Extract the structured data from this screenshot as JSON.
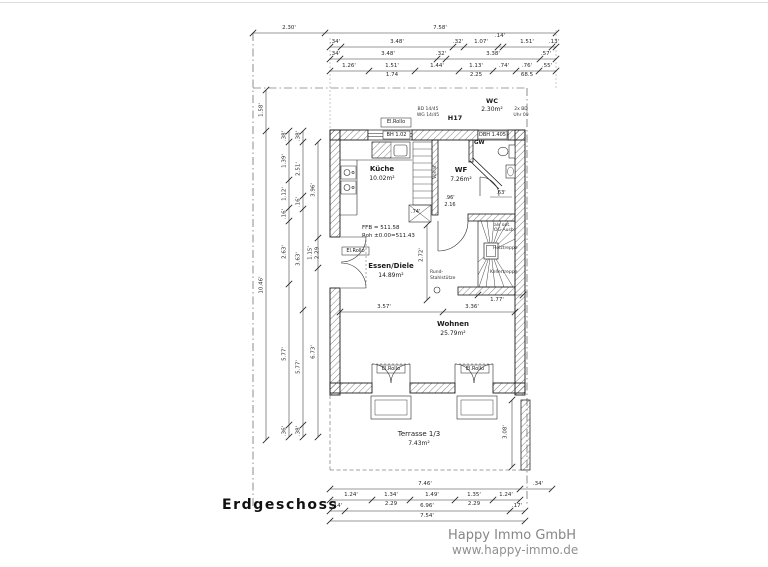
{
  "page": {
    "title": "Erdgeschoss"
  },
  "watermark": {
    "company": "Happy Immo GmbH",
    "website": "www.happy-immo.de"
  },
  "rooms": {
    "kueche_name": "Küche",
    "kueche_area": "10.02m²",
    "wf_name": "WF",
    "wf_area": "7.26m²",
    "wc_name": "WC",
    "wc_area": "2.30m²",
    "gw": "GW",
    "essen_name": "Essen/Diele",
    "essen_area": "14.89m²",
    "wohnen_name": "Wohnen",
    "wohnen_area": "25.79m²",
    "terrasse_name": "Terrasse 1/3",
    "terrasse_area": "7.43m²"
  },
  "annotations": {
    "h17": "H17",
    "bd1a": "BD 14/45",
    "bd1b": "WG 14/45",
    "bd2a": "2x BD",
    "bd2b": "Uhr 09",
    "el_rollo_top": "El.Rollo",
    "el_rollo_left": "El.Rollo",
    "el_rollo_door1": "El.Rollo",
    "el_rollo_door2": "El.Rollo",
    "bh": "BH 1.02",
    "dbh": "DBH 1.405",
    "ffb": "FFB = 511.58",
    "roh": "Roh ±0.00=511.43",
    "column_a": "Rund-",
    "column_b": "Stahlstütze",
    "pantry": "Vorrat",
    "niche": ".74'",
    "door_width": ".96'",
    "door_height": "2.16",
    "wc_door": ".63'",
    "stair_note_a": "als opt.",
    "stair_note_b": "OG-Ausb.",
    "stair_label_a": "Holztreppe",
    "stair_label_b": "Kellertreppe"
  },
  "dims": {
    "top1": [
      "2.30'",
      "7.58'"
    ],
    "top2": [
      ".34'",
      "3.48'",
      ".32'",
      "1.07'",
      ".14'",
      "1.51'",
      ".13'"
    ],
    "top3": [
      ".34'",
      "3.48'",
      ".32'",
      "3.38'",
      ".57'"
    ],
    "top4": [
      "1.26'",
      "1.51'",
      "1.44'",
      "1.13'",
      ".74'",
      ".76'",
      ".55'"
    ],
    "top4sub": [
      "1.74",
      "2.25",
      "68.5"
    ],
    "left1": [
      "1.58'",
      "10.46'"
    ],
    "left2": [
      ".38'",
      "1.39'",
      "1.12'",
      ".16'",
      "2.63'",
      "5.77'",
      ".36'"
    ],
    "left3": [
      ".38'",
      "2.51'",
      ".16'",
      "3.63'",
      "5.77'",
      ".38'"
    ],
    "left4": [
      "3.96'",
      "1.15'",
      "2.29",
      "6.73'"
    ],
    "bottom1": [
      "7.46'",
      ".34'"
    ],
    "bottom2": [
      "1.24'",
      "1.34'",
      "1.49'",
      "1.35'",
      "1.24'"
    ],
    "bottom2sub": [
      "2.29",
      "2.29"
    ],
    "bottom3": [
      ".14'",
      "6.96'",
      ".17'"
    ],
    "bottom4": [
      "7.54'"
    ],
    "inner_h": [
      "3.57'",
      "3.36'"
    ],
    "inner_v": "2.72'",
    "stair_dim": "1.77'",
    "terrace_v": "3.08'"
  }
}
